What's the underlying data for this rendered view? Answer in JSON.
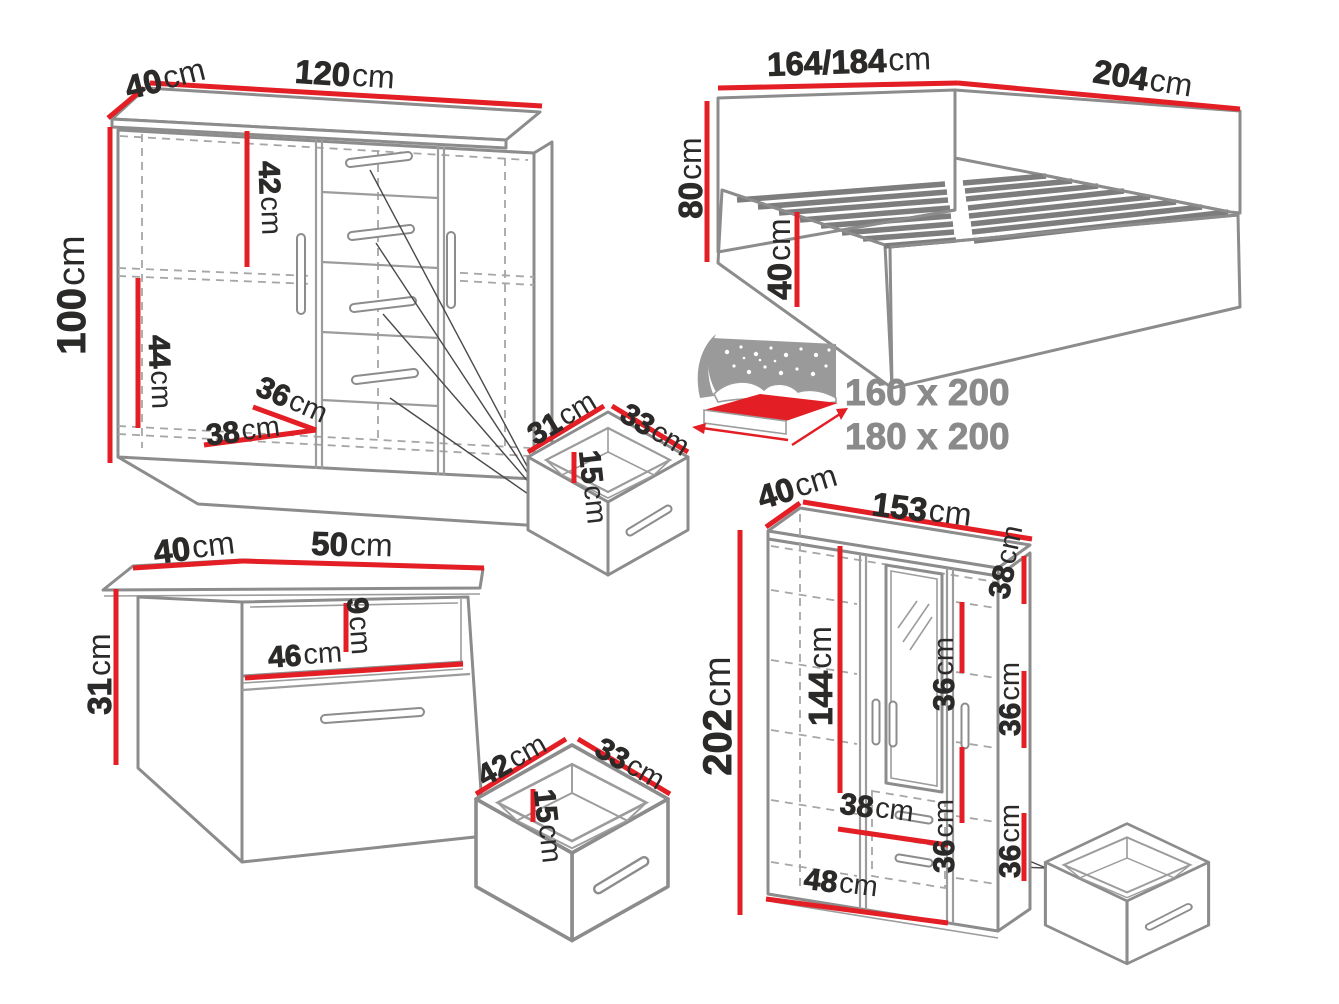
{
  "colors": {
    "dimension_red": "#e31e24",
    "outline_gray": "#8c8c8c",
    "text_dark": "#2b2a29",
    "text_muted": "#8a8a8a",
    "background": "#ffffff"
  },
  "dresser": {
    "depth": {
      "value": "40",
      "unit": "cm"
    },
    "width": {
      "value": "120",
      "unit": "cm"
    },
    "height": {
      "value": "100",
      "unit": "cm"
    },
    "upper_section": {
      "value": "42",
      "unit": "cm"
    },
    "lower_section": {
      "value": "44",
      "unit": "cm"
    },
    "inner_depth": {
      "value": "36",
      "unit": "cm"
    },
    "inner_width": {
      "value": "38",
      "unit": "cm"
    }
  },
  "bed": {
    "width": {
      "value": "164/184",
      "unit": "cm"
    },
    "length": {
      "value": "204",
      "unit": "cm"
    },
    "headboard_height": {
      "value": "80",
      "unit": "cm"
    },
    "base_height": {
      "value": "40",
      "unit": "cm"
    },
    "mattress_sizes": [
      "160 x 200",
      "180 x 200"
    ]
  },
  "top_drawer": {
    "width": {
      "value": "31",
      "unit": "cm"
    },
    "depth": {
      "value": "33",
      "unit": "cm"
    },
    "height": {
      "value": "15",
      "unit": "cm"
    }
  },
  "nightstand": {
    "depth": {
      "value": "40",
      "unit": "cm"
    },
    "width": {
      "value": "50",
      "unit": "cm"
    },
    "height": {
      "value": "31",
      "unit": "cm"
    },
    "inner_width": {
      "value": "46",
      "unit": "cm"
    },
    "niche_height": {
      "value": "9",
      "unit": "cm"
    }
  },
  "nightstand_drawer": {
    "width": {
      "value": "42",
      "unit": "cm"
    },
    "depth": {
      "value": "33",
      "unit": "cm"
    },
    "height": {
      "value": "15",
      "unit": "cm"
    }
  },
  "wardrobe": {
    "depth": {
      "value": "40",
      "unit": "cm"
    },
    "width": {
      "value": "153",
      "unit": "cm"
    },
    "height": {
      "value": "202",
      "unit": "cm"
    },
    "hanging_height": {
      "value": "144",
      "unit": "cm"
    },
    "top_shelf": {
      "value": "38",
      "unit": "cm"
    },
    "mid_shelf_a": {
      "value": "36",
      "unit": "cm"
    },
    "mid_shelf_b": {
      "value": "36",
      "unit": "cm"
    },
    "right_shelf_a": {
      "value": "36",
      "unit": "cm"
    },
    "right_shelf_b": {
      "value": "36",
      "unit": "cm"
    },
    "drawer_width": {
      "value": "38",
      "unit": "cm"
    },
    "bottom_width": {
      "value": "48",
      "unit": "cm"
    }
  }
}
